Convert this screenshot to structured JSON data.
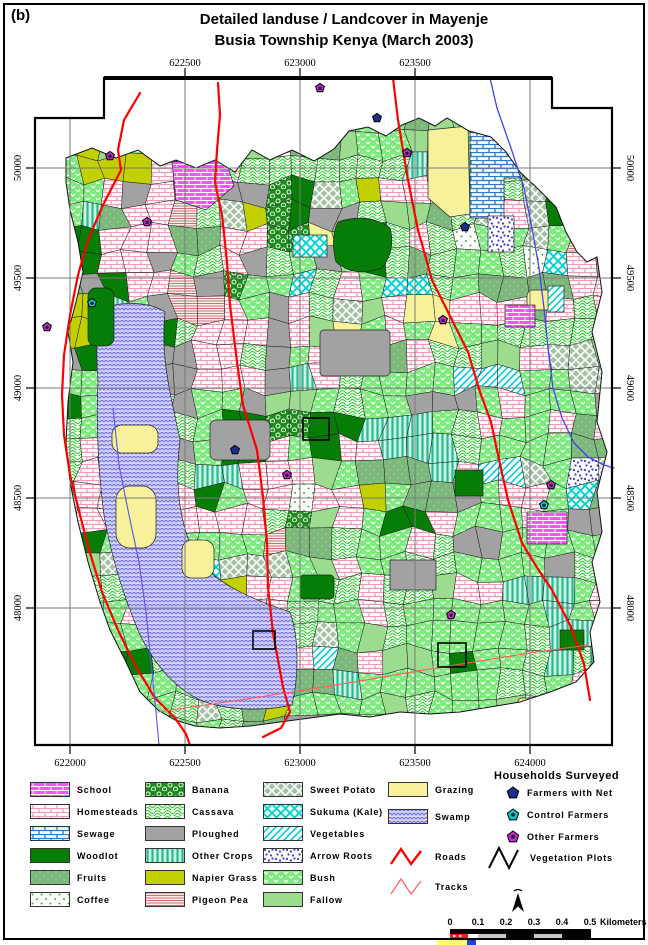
{
  "figure_label": "(b)",
  "title": {
    "line1": "Detailed landuse / Landcover in Mayenje",
    "line2": "Busia Township Kenya (March 2003)"
  },
  "axes": {
    "top": [
      "622500",
      "623000",
      "623500"
    ],
    "bottom": [
      "622000",
      "622500",
      "623000",
      "623500",
      "624000"
    ],
    "left": [
      "50000",
      "49500",
      "49000",
      "48500",
      "48000"
    ],
    "right": [
      "50000",
      "49500",
      "49000",
      "48500",
      "48000"
    ]
  },
  "legend": {
    "col1": [
      {
        "id": "school",
        "label": "School",
        "color": "#ff50ff"
      },
      {
        "id": "homesteads",
        "label": "Homesteads",
        "color": "#efa6bc"
      },
      {
        "id": "sewage",
        "label": "Sewage",
        "color": "#2f7cc4"
      },
      {
        "id": "woodlot",
        "label": "Woodlot",
        "color": "#067d06"
      },
      {
        "id": "fruits",
        "label": "Fruits",
        "color": "#7cb87c"
      },
      {
        "id": "coffee",
        "label": "Coffee",
        "color": "#4aa84a"
      }
    ],
    "col2": [
      {
        "id": "banana",
        "label": "Banana",
        "color": "#1e8a1e"
      },
      {
        "id": "cassava",
        "label": "Cassava",
        "color": "#2ecc2e"
      },
      {
        "id": "ploughed",
        "label": "Ploughed",
        "color": "#a2a2a2"
      },
      {
        "id": "other-crops",
        "label": "Other Crops",
        "color": "#2cb892"
      },
      {
        "id": "napier",
        "label": "Napier Grass",
        "color": "#c2cf00"
      },
      {
        "id": "pigeon-pea",
        "label": "Pigeon Pea",
        "color": "#cc7272"
      }
    ],
    "col3": [
      {
        "id": "sweet-potato",
        "label": "Sweet Potato",
        "color": "#a3c2a3"
      },
      {
        "id": "sukuma",
        "label": "Sukuma (Kale)",
        "color": "#00cfcf"
      },
      {
        "id": "vegetables",
        "label": "Vegetables",
        "color": "#00c4dc"
      },
      {
        "id": "arrow-roots",
        "label": "Arrow Roots",
        "color": "#3b3bd0"
      },
      {
        "id": "bush",
        "label": "Bush",
        "color": "#82e882"
      },
      {
        "id": "fallow",
        "label": "Fallow",
        "color": "#9cdc8e"
      }
    ],
    "col4": [
      {
        "id": "grazing",
        "label": "Grazing",
        "color": "#f6f19a"
      },
      {
        "id": "swamp",
        "label": "Swamp",
        "color": "#d6d6f7"
      }
    ],
    "roads_label": "Roads",
    "tracks_label": "Tracks",
    "households_header": "Households Surveyed",
    "households": [
      {
        "id": "net",
        "label": "Farmers with Net",
        "color": "#1b2f8c"
      },
      {
        "id": "control",
        "label": "Control Farmers",
        "color": "#00c8c8"
      },
      {
        "id": "other",
        "label": "Other Farmers",
        "color": "#c828c8"
      }
    ],
    "vegetation_label": "Vegetation Plots"
  },
  "scalebar": {
    "ticks": [
      "0",
      "0.1",
      "0.2",
      "0.3",
      "0.4",
      "0.5"
    ],
    "unit": "Kilometers"
  },
  "map": {
    "colors": {
      "roads": "#ff0000",
      "tracks": "#ff5a5a",
      "river": "#4444ee",
      "grid": "#7a7a7a",
      "neatline": "#000000",
      "boundary_red": "#ff0000"
    },
    "household_colors": {
      "net": "#1b2f8c",
      "control": "#00c8c8",
      "other": "#c828c8"
    },
    "markers": [
      {
        "x": 320,
        "y": 88,
        "type": "other"
      },
      {
        "x": 377,
        "y": 118,
        "type": "net"
      },
      {
        "x": 110,
        "y": 156,
        "type": "other"
      },
      {
        "x": 407,
        "y": 153,
        "type": "other"
      },
      {
        "x": 147,
        "y": 222,
        "type": "other"
      },
      {
        "x": 465,
        "y": 227,
        "type": "net"
      },
      {
        "x": 92,
        "y": 303,
        "type": "control"
      },
      {
        "x": 47,
        "y": 327,
        "type": "other"
      },
      {
        "x": 443,
        "y": 320,
        "type": "other"
      },
      {
        "x": 235,
        "y": 450,
        "type": "net"
      },
      {
        "x": 287,
        "y": 475,
        "type": "other"
      },
      {
        "x": 551,
        "y": 485,
        "type": "other"
      },
      {
        "x": 544,
        "y": 505,
        "type": "control"
      },
      {
        "x": 451,
        "y": 615,
        "type": "other"
      }
    ]
  }
}
